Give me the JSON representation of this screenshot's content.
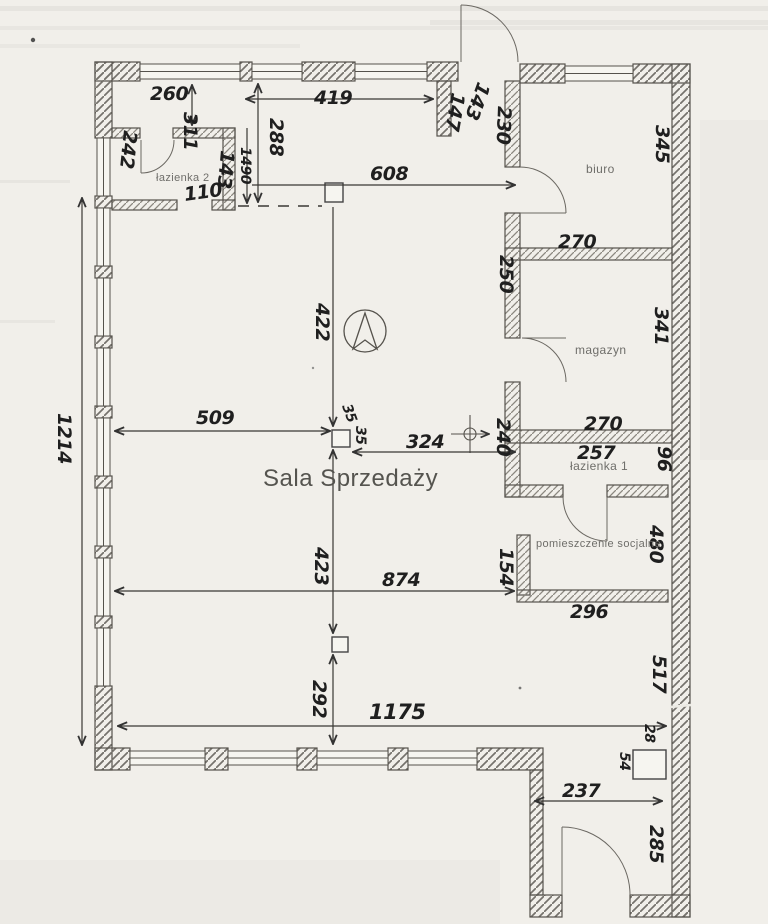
{
  "plan": {
    "main_room": "Sala Sprzedaży",
    "rooms": {
      "lazienka2": "łazienka 2",
      "biuro": "biuro",
      "magazyn": "magazyn",
      "lazienka1": "łazienka 1",
      "socjalne": "pomieszczenie socjalne"
    }
  },
  "dimensions": {
    "d260": "260",
    "d311": "311",
    "d242": "242",
    "d110": "110",
    "d143a": "143",
    "d1490": "1490",
    "d288": "288",
    "d419": "419",
    "d147": "147",
    "d143b": "143",
    "d230": "230",
    "d608": "608",
    "d345": "345",
    "d270a": "270",
    "d250": "250",
    "d341": "341",
    "d270b": "270",
    "d240": "240",
    "d257": "257",
    "d96": "96",
    "d154": "154",
    "d480": "480",
    "d296": "296",
    "d509": "509",
    "d324": "324",
    "d35a": "35",
    "d35b": "35",
    "d422": "422",
    "d423": "423",
    "d292": "292",
    "d874": "874",
    "d1175": "1175",
    "d1214": "1214",
    "d517": "517",
    "d28": "28",
    "d54": "54",
    "d237": "237",
    "d285": "285"
  },
  "icons": {
    "compass": "compass-north-icon",
    "crosshair": "center-axis-icon"
  },
  "colors": {
    "paper": "#f1efea",
    "ink": "#1f1f1f",
    "hatch_exterior": "#75726c",
    "hatch_interior": "#8a877f",
    "printed_gray": "#6f6e6a"
  }
}
